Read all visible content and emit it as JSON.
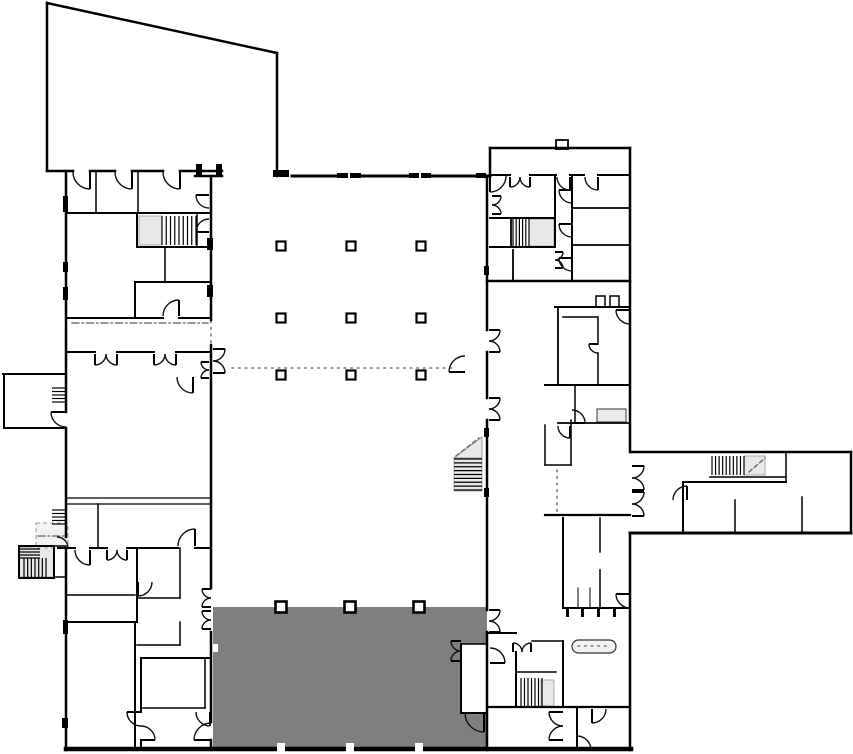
{
  "meta": {
    "label": "architectural-floor-plan",
    "width": 853,
    "height": 754
  },
  "palette": {
    "bg": "#ffffff",
    "wall": "#000000",
    "shadow": "#999999",
    "gray_zone": "#7f7f7f",
    "landing": "#e8e8e8",
    "stair_bg": "#d6d6d6",
    "guide": "#777777",
    "fixture_fill": "#f2f2f2"
  },
  "fills": [
    {
      "x": 213,
      "y": 607,
      "w": 274,
      "h": 142,
      "fill": "#7f7f7f",
      "name": "shaded-zone"
    },
    {
      "x": 461,
      "y": 644,
      "w": 26,
      "h": 69,
      "fill": "#ffffff",
      "name": "zone-cutout-room"
    },
    {
      "x": 213,
      "y": 644,
      "w": 5,
      "h": 8,
      "fill": "#ffffff",
      "name": "wall-notch"
    }
  ],
  "polygons": [
    {
      "points": "454,458 482,458 482,437",
      "fill": "#e9e9e9",
      "stroke": "#999999",
      "name": "stair-landing-triangle"
    }
  ],
  "landings": [
    {
      "x": 139,
      "y": 216,
      "w": 23,
      "h": 29
    },
    {
      "x": 529,
      "y": 219,
      "w": 25,
      "h": 27
    },
    {
      "x": 744,
      "y": 456,
      "w": 21,
      "h": 19
    },
    {
      "x": 541,
      "y": 680,
      "w": 13,
      "h": 26
    },
    {
      "x": 19,
      "y": 547,
      "w": 35,
      "h": 30
    },
    {
      "x": 454,
      "y": 458,
      "w": 28,
      "h": 33
    }
  ],
  "fixtures": [
    {
      "x": 36,
      "y": 523,
      "w": 32,
      "h": 25,
      "fill": "#f2f2f2",
      "stroke": "#999999",
      "sw": 1,
      "dash": "4,3",
      "name": "entry-vestibule"
    },
    {
      "x": 597,
      "y": 409,
      "w": 29,
      "h": 13,
      "fill": "#ececec",
      "stroke": "#555555",
      "sw": 1.2,
      "name": "casework-fixture"
    },
    {
      "x": 572,
      "y": 640,
      "w": 44,
      "h": 13,
      "rx": 6.5,
      "fill": "#f2f2f2",
      "stroke": "#333333",
      "sw": 1.2,
      "name": "reception-counter"
    },
    {
      "x": 556,
      "y": 140,
      "w": 12,
      "h": 9,
      "fill": "#ffffff",
      "stroke": "#000000",
      "sw": 1.8,
      "name": "roof-tab"
    },
    {
      "x": 596,
      "y": 296,
      "w": 9,
      "h": 11,
      "fill": "#ffffff",
      "stroke": "#000000",
      "sw": 1.5,
      "name": "wall-tab"
    },
    {
      "x": 610,
      "y": 296,
      "w": 9,
      "h": 11,
      "fill": "#ffffff",
      "stroke": "#000000",
      "sw": 1.5,
      "name": "wall-tab"
    }
  ],
  "stairs": [
    {
      "x": 162,
      "y": 216,
      "w": 34,
      "h": 29,
      "n": 8,
      "dir": "v",
      "name": "stair-northwest"
    },
    {
      "x": 513,
      "y": 219,
      "w": 16,
      "h": 27,
      "n": 5,
      "dir": "v",
      "name": "stair-northeast"
    },
    {
      "x": 454,
      "y": 459,
      "w": 28,
      "h": 31,
      "n": 8,
      "dir": "h",
      "name": "stair-hall-east"
    },
    {
      "x": 712,
      "y": 456,
      "w": 32,
      "h": 19,
      "n": 9,
      "dir": "v",
      "name": "stair-east-arm"
    },
    {
      "x": 521,
      "y": 678,
      "w": 21,
      "h": 28,
      "n": 6,
      "dir": "v",
      "name": "stair-southeast"
    },
    {
      "x": 24,
      "y": 558,
      "w": 22,
      "h": 20,
      "n": 6,
      "dir": "v",
      "name": "stair-southwest-winder"
    },
    {
      "x": 19,
      "y": 549,
      "w": 21,
      "h": 9,
      "n": 3,
      "dir": "h",
      "name": "stair-southwest-winder-top"
    },
    {
      "x": 52,
      "y": 388,
      "w": 14,
      "h": 14,
      "n": 4,
      "dir": "h",
      "name": "entry-steps-west"
    },
    {
      "x": 52,
      "y": 510,
      "w": 15,
      "h": 14,
      "n": 4,
      "dir": "h",
      "name": "entry-steps-southwest"
    }
  ],
  "guides": [
    {
      "x1": 232,
      "y1": 368,
      "x2": 455,
      "y2": 368,
      "style": "dot"
    },
    {
      "x1": 211,
      "y1": 321,
      "x2": 211,
      "y2": 344,
      "style": "dot"
    },
    {
      "x1": 557,
      "y1": 470,
      "x2": 557,
      "y2": 512,
      "style": "dot"
    },
    {
      "x1": 72,
      "y1": 323,
      "x2": 208,
      "y2": 323,
      "style": "dashdot"
    },
    {
      "x1": 456,
      "y1": 456,
      "x2": 479,
      "y2": 438,
      "style": "dash"
    },
    {
      "x1": 749,
      "y1": 472,
      "x2": 765,
      "y2": 458,
      "style": "dash"
    },
    {
      "x1": 578,
      "y1": 646,
      "x2": 610,
      "y2": 646,
      "style": "dot"
    },
    {
      "x1": 38,
      "y1": 536,
      "x2": 66,
      "y2": 536,
      "style": "dashdot"
    }
  ],
  "walls": [
    [
      47,
      3,
      277,
      53,
      2.5
    ],
    [
      47,
      3,
      47,
      171,
      2.5
    ],
    [
      277,
      53,
      277,
      176,
      2.5
    ],
    [
      47,
      171,
      73,
      171,
      2.5
    ],
    [
      90,
      171,
      115,
      171,
      2.5
    ],
    [
      132,
      171,
      163,
      171,
      2.5
    ],
    [
      180,
      171,
      222,
      171,
      2.5
    ],
    [
      195,
      176,
      222,
      176,
      2.5
    ],
    [
      292,
      176,
      336,
      176,
      3
    ],
    [
      362,
      176,
      408,
      176,
      3
    ],
    [
      432,
      176,
      475,
      176,
      3
    ],
    [
      487,
      176,
      490,
      176,
      3
    ],
    [
      66,
      171,
      66,
      412,
      2.5
    ],
    [
      66,
      428,
      66,
      537,
      2.5
    ],
    [
      66,
      548,
      66,
      750,
      2.5
    ],
    [
      3,
      374,
      66,
      374,
      2
    ],
    [
      4,
      374,
      4,
      428,
      2
    ],
    [
      4,
      428,
      66,
      428,
      2
    ],
    [
      19,
      546,
      54,
      546,
      2
    ],
    [
      19,
      546,
      19,
      578,
      2
    ],
    [
      19,
      578,
      54,
      578,
      2
    ],
    [
      54,
      546,
      54,
      578,
      2
    ],
    [
      54,
      546,
      66,
      546,
      1.5
    ],
    [
      54,
      577,
      66,
      577,
      1.5
    ],
    [
      66,
      213,
      211,
      213,
      2
    ],
    [
      96,
      171,
      96,
      213,
      1.5
    ],
    [
      138,
      171,
      138,
      213,
      1.5
    ],
    [
      137,
      213,
      137,
      247,
      2
    ],
    [
      197,
      213,
      197,
      247,
      1.5
    ],
    [
      137,
      247,
      211,
      247,
      2
    ],
    [
      165,
      247,
      165,
      282,
      1.5
    ],
    [
      135,
      282,
      211,
      282,
      2
    ],
    [
      135,
      282,
      135,
      318,
      2
    ],
    [
      66,
      318,
      163,
      318,
      2
    ],
    [
      179,
      318,
      211,
      318,
      2
    ],
    [
      66,
      352,
      95,
      352,
      2
    ],
    [
      117,
      352,
      154,
      352,
      2
    ],
    [
      176,
      352,
      211,
      352,
      2
    ],
    [
      66,
      498,
      211,
      498,
      1.3
    ],
    [
      66,
      504,
      211,
      504,
      1.3
    ],
    [
      98,
      504,
      98,
      548,
      1.5
    ],
    [
      66,
      548,
      75,
      548,
      2
    ],
    [
      90,
      548,
      107,
      548,
      2
    ],
    [
      127,
      548,
      178,
      548,
      2
    ],
    [
      195,
      548,
      211,
      548,
      2
    ],
    [
      137,
      548,
      137,
      622,
      2
    ],
    [
      66,
      595,
      135,
      595,
      1.5
    ],
    [
      180,
      548,
      180,
      598,
      1.5
    ],
    [
      137,
      598,
      180,
      598,
      1.5
    ],
    [
      66,
      622,
      137,
      622,
      2
    ],
    [
      135,
      622,
      135,
      750,
      2
    ],
    [
      137,
      645,
      180,
      645,
      1.5
    ],
    [
      180,
      622,
      180,
      645,
      1.5
    ],
    [
      141,
      658,
      211,
      658,
      2
    ],
    [
      141,
      658,
      141,
      712,
      2
    ],
    [
      141,
      740,
      141,
      750,
      2
    ],
    [
      143,
      708,
      205,
      708,
      1.5
    ],
    [
      205,
      658,
      205,
      708,
      1.5
    ],
    [
      211,
      176,
      211,
      320,
      2.5
    ],
    [
      211,
      345,
      211,
      588,
      2.5
    ],
    [
      211,
      632,
      211,
      722,
      2.5
    ],
    [
      211,
      740,
      211,
      750,
      2.5
    ],
    [
      487,
      176,
      487,
      330,
      2.5
    ],
    [
      487,
      352,
      487,
      398,
      2.5
    ],
    [
      487,
      420,
      487,
      610,
      2.5
    ],
    [
      487,
      632,
      487,
      750,
      2.5
    ],
    [
      490,
      148,
      630,
      148,
      2.5
    ],
    [
      490,
      148,
      490,
      176,
      2.5
    ],
    [
      490,
      175,
      510,
      175,
      2
    ],
    [
      530,
      175,
      556,
      175,
      2
    ],
    [
      570,
      175,
      584,
      175,
      2
    ],
    [
      598,
      175,
      630,
      175,
      2
    ],
    [
      630,
      148,
      630,
      452,
      2.5
    ],
    [
      630,
      533,
      630,
      750,
      2.5
    ],
    [
      490,
      218,
      555,
      218,
      2
    ],
    [
      511,
      218,
      511,
      247,
      1.8
    ],
    [
      490,
      247,
      555,
      247,
      2
    ],
    [
      555,
      175,
      555,
      247,
      2
    ],
    [
      572,
      175,
      572,
      281,
      2
    ],
    [
      572,
      208,
      630,
      208,
      1.8
    ],
    [
      572,
      245,
      630,
      245,
      1.8
    ],
    [
      487,
      281,
      630,
      281,
      2.5
    ],
    [
      513,
      250,
      513,
      281,
      1.8
    ],
    [
      555,
      307,
      630,
      307,
      2
    ],
    [
      558,
      307,
      558,
      385,
      1.8
    ],
    [
      563,
      317,
      597,
      317,
      1.5
    ],
    [
      598,
      317,
      598,
      344,
      1.5
    ],
    [
      598,
      353,
      598,
      385,
      1.5
    ],
    [
      545,
      385,
      630,
      385,
      2
    ],
    [
      575,
      385,
      575,
      423,
      1.5
    ],
    [
      558,
      423,
      630,
      423,
      1.8
    ],
    [
      545,
      425,
      545,
      465,
      1.5
    ],
    [
      545,
      465,
      571,
      465,
      1.5
    ],
    [
      571,
      420,
      571,
      465,
      1.5
    ],
    [
      545,
      515,
      630,
      515,
      2.2
    ],
    [
      563,
      518,
      563,
      608,
      2
    ],
    [
      600,
      518,
      600,
      552,
      1.5
    ],
    [
      600,
      570,
      600,
      608,
      1.5
    ],
    [
      563,
      608,
      630,
      608,
      2
    ],
    [
      578,
      588,
      578,
      608,
      1
    ],
    [
      590,
      588,
      590,
      608,
      1
    ],
    [
      488,
      633,
      516,
      633,
      2
    ],
    [
      532,
      641,
      563,
      641,
      1.5
    ],
    [
      563,
      641,
      563,
      707,
      2
    ],
    [
      516,
      652,
      516,
      707,
      2
    ],
    [
      516,
      672,
      556,
      672,
      1.5
    ],
    [
      488,
      707,
      630,
      707,
      2.2
    ],
    [
      577,
      707,
      577,
      750,
      2
    ],
    [
      461,
      644,
      461,
      713,
      2
    ],
    [
      461,
      713,
      487,
      713,
      2
    ],
    [
      461,
      644,
      487,
      644,
      1.5
    ],
    [
      632,
      452,
      851,
      452,
      2.5
    ],
    [
      851,
      452,
      851,
      533,
      2.5
    ],
    [
      630,
      533,
      851,
      533,
      3
    ],
    [
      786,
      452,
      786,
      482,
      1.5
    ],
    [
      683,
      482,
      786,
      482,
      2
    ],
    [
      683,
      482,
      683,
      533,
      2
    ],
    [
      710,
      477,
      786,
      477,
      1.5
    ],
    [
      735,
      500,
      735,
      533,
      1.5
    ],
    [
      802,
      497,
      802,
      533,
      1.5
    ],
    [
      66,
      749,
      631,
      749,
      4.5
    ]
  ],
  "bars": [
    [
      273,
      170,
      16,
      7
    ],
    [
      337,
      173,
      11,
      5
    ],
    [
      350,
      173,
      11,
      5
    ],
    [
      409,
      173,
      10,
      5
    ],
    [
      421,
      173,
      10,
      5
    ],
    [
      476,
      173,
      10,
      5
    ],
    [
      207,
      238,
      6,
      12
    ],
    [
      207,
      285,
      6,
      12
    ],
    [
      484,
      266,
      5,
      9
    ],
    [
      484,
      428,
      5,
      9
    ],
    [
      484,
      488,
      5,
      9
    ],
    [
      63,
      196,
      5,
      16
    ],
    [
      63,
      262,
      5,
      10
    ],
    [
      63,
      287,
      5,
      13
    ],
    [
      63,
      620,
      5,
      14
    ],
    [
      62,
      718,
      6,
      10
    ],
    [
      196,
      164,
      6,
      12
    ],
    [
      216,
      164,
      6,
      12
    ],
    [
      566,
      608,
      3,
      9
    ],
    [
      581,
      608,
      3,
      9
    ],
    [
      597,
      608,
      3,
      9
    ],
    [
      613,
      608,
      3,
      9
    ]
  ],
  "white_notches": [
    [
      277,
      743,
      8,
      9
    ],
    [
      346,
      743,
      8,
      9
    ],
    [
      415,
      743,
      8,
      9
    ]
  ],
  "columns": {
    "size": 9,
    "fill": "#ffffff",
    "items": [
      [
        281,
        246
      ],
      [
        351,
        246
      ],
      [
        421,
        246
      ],
      [
        281,
        318
      ],
      [
        351,
        318
      ],
      [
        421,
        318
      ],
      [
        281,
        375
      ],
      [
        351,
        375
      ],
      [
        421,
        375
      ]
    ]
  },
  "columns_bold": {
    "size": 11,
    "fill": "#ffffff",
    "items": [
      [
        281,
        607
      ],
      [
        350,
        607
      ],
      [
        419,
        607
      ]
    ]
  },
  "doors": [
    [
      90,
      172,
      17,
      180,
      90
    ],
    [
      132,
      172,
      17,
      180,
      90
    ],
    [
      180,
      172,
      17,
      180,
      90
    ],
    [
      209,
      195,
      13,
      90,
      180
    ],
    [
      209,
      232,
      13,
      270,
      180
    ],
    [
      490,
      176,
      16,
      0,
      90
    ],
    [
      510,
      177,
      10,
      0,
      90
    ],
    [
      530,
      177,
      10,
      180,
      90
    ],
    [
      570,
      177,
      13,
      180,
      90
    ],
    [
      598,
      177,
      13,
      180,
      90
    ],
    [
      492,
      196,
      9,
      90,
      0
    ],
    [
      492,
      214,
      9,
      270,
      0
    ],
    [
      572,
      190,
      13,
      90,
      180
    ],
    [
      572,
      224,
      13,
      90,
      180
    ],
    [
      572,
      258,
      13,
      90,
      180
    ],
    [
      555,
      252,
      8,
      90,
      0
    ],
    [
      555,
      268,
      8,
      270,
      0
    ],
    [
      213,
      349,
      12,
      90,
      0
    ],
    [
      213,
      373,
      12,
      270,
      0
    ],
    [
      209,
      362,
      8,
      90,
      180
    ],
    [
      209,
      378,
      8,
      270,
      180
    ],
    [
      489,
      330,
      11,
      90,
      0
    ],
    [
      489,
      352,
      11,
      270,
      0
    ],
    [
      489,
      398,
      11,
      90,
      0
    ],
    [
      489,
      420,
      11,
      270,
      0
    ],
    [
      489,
      610,
      11,
      90,
      0
    ],
    [
      489,
      632,
      11,
      270,
      0
    ],
    [
      465,
      372,
      16,
      270,
      180
    ],
    [
      193,
      377,
      16,
      180,
      90
    ],
    [
      95,
      354,
      11,
      0,
      90
    ],
    [
      117,
      354,
      11,
      180,
      90
    ],
    [
      154,
      354,
      11,
      0,
      90
    ],
    [
      176,
      354,
      11,
      180,
      90
    ],
    [
      90,
      550,
      15,
      180,
      90
    ],
    [
      107,
      550,
      10,
      0,
      90
    ],
    [
      127,
      550,
      10,
      180,
      90
    ],
    [
      195,
      546,
      17,
      180,
      270
    ],
    [
      179,
      316,
      16,
      180,
      270
    ],
    [
      138,
      582,
      14,
      0,
      90
    ],
    [
      141,
      712,
      14,
      90,
      180
    ],
    [
      141,
      740,
      14,
      270,
      0
    ],
    [
      210,
      712,
      14,
      180,
      90
    ],
    [
      211,
      589,
      9,
      90,
      180
    ],
    [
      211,
      607,
      9,
      270,
      180
    ],
    [
      211,
      611,
      9,
      90,
      180
    ],
    [
      211,
      629,
      9,
      270,
      180
    ],
    [
      211,
      740,
      17,
      270,
      180
    ],
    [
      630,
      594,
      14,
      90,
      180
    ],
    [
      598,
      344,
      9,
      90,
      180
    ],
    [
      630,
      310,
      14,
      90,
      180
    ],
    [
      572,
      423,
      13,
      270,
      0
    ],
    [
      570,
      426,
      12,
      180,
      90
    ],
    [
      632,
      466,
      12,
      90,
      0
    ],
    [
      632,
      490,
      12,
      270,
      0
    ],
    [
      632,
      492,
      12,
      90,
      0
    ],
    [
      632,
      516,
      12,
      270,
      0
    ],
    [
      687,
      500,
      14,
      180,
      270
    ],
    [
      490,
      663,
      15,
      270,
      0
    ],
    [
      513,
      652,
      9,
      0,
      270
    ],
    [
      531,
      652,
      9,
      180,
      270
    ],
    [
      563,
      712,
      14,
      90,
      180
    ],
    [
      563,
      740,
      14,
      270,
      180
    ],
    [
      592,
      709,
      14,
      0,
      90
    ],
    [
      461,
      641,
      10,
      90,
      180
    ],
    [
      461,
      661,
      10,
      270,
      180
    ],
    [
      484,
      713,
      19,
      180,
      90
    ],
    [
      577,
      750,
      14,
      270,
      0
    ],
    [
      66,
      412,
      15,
      90,
      180
    ],
    [
      57,
      548,
      11,
      270,
      0
    ]
  ]
}
